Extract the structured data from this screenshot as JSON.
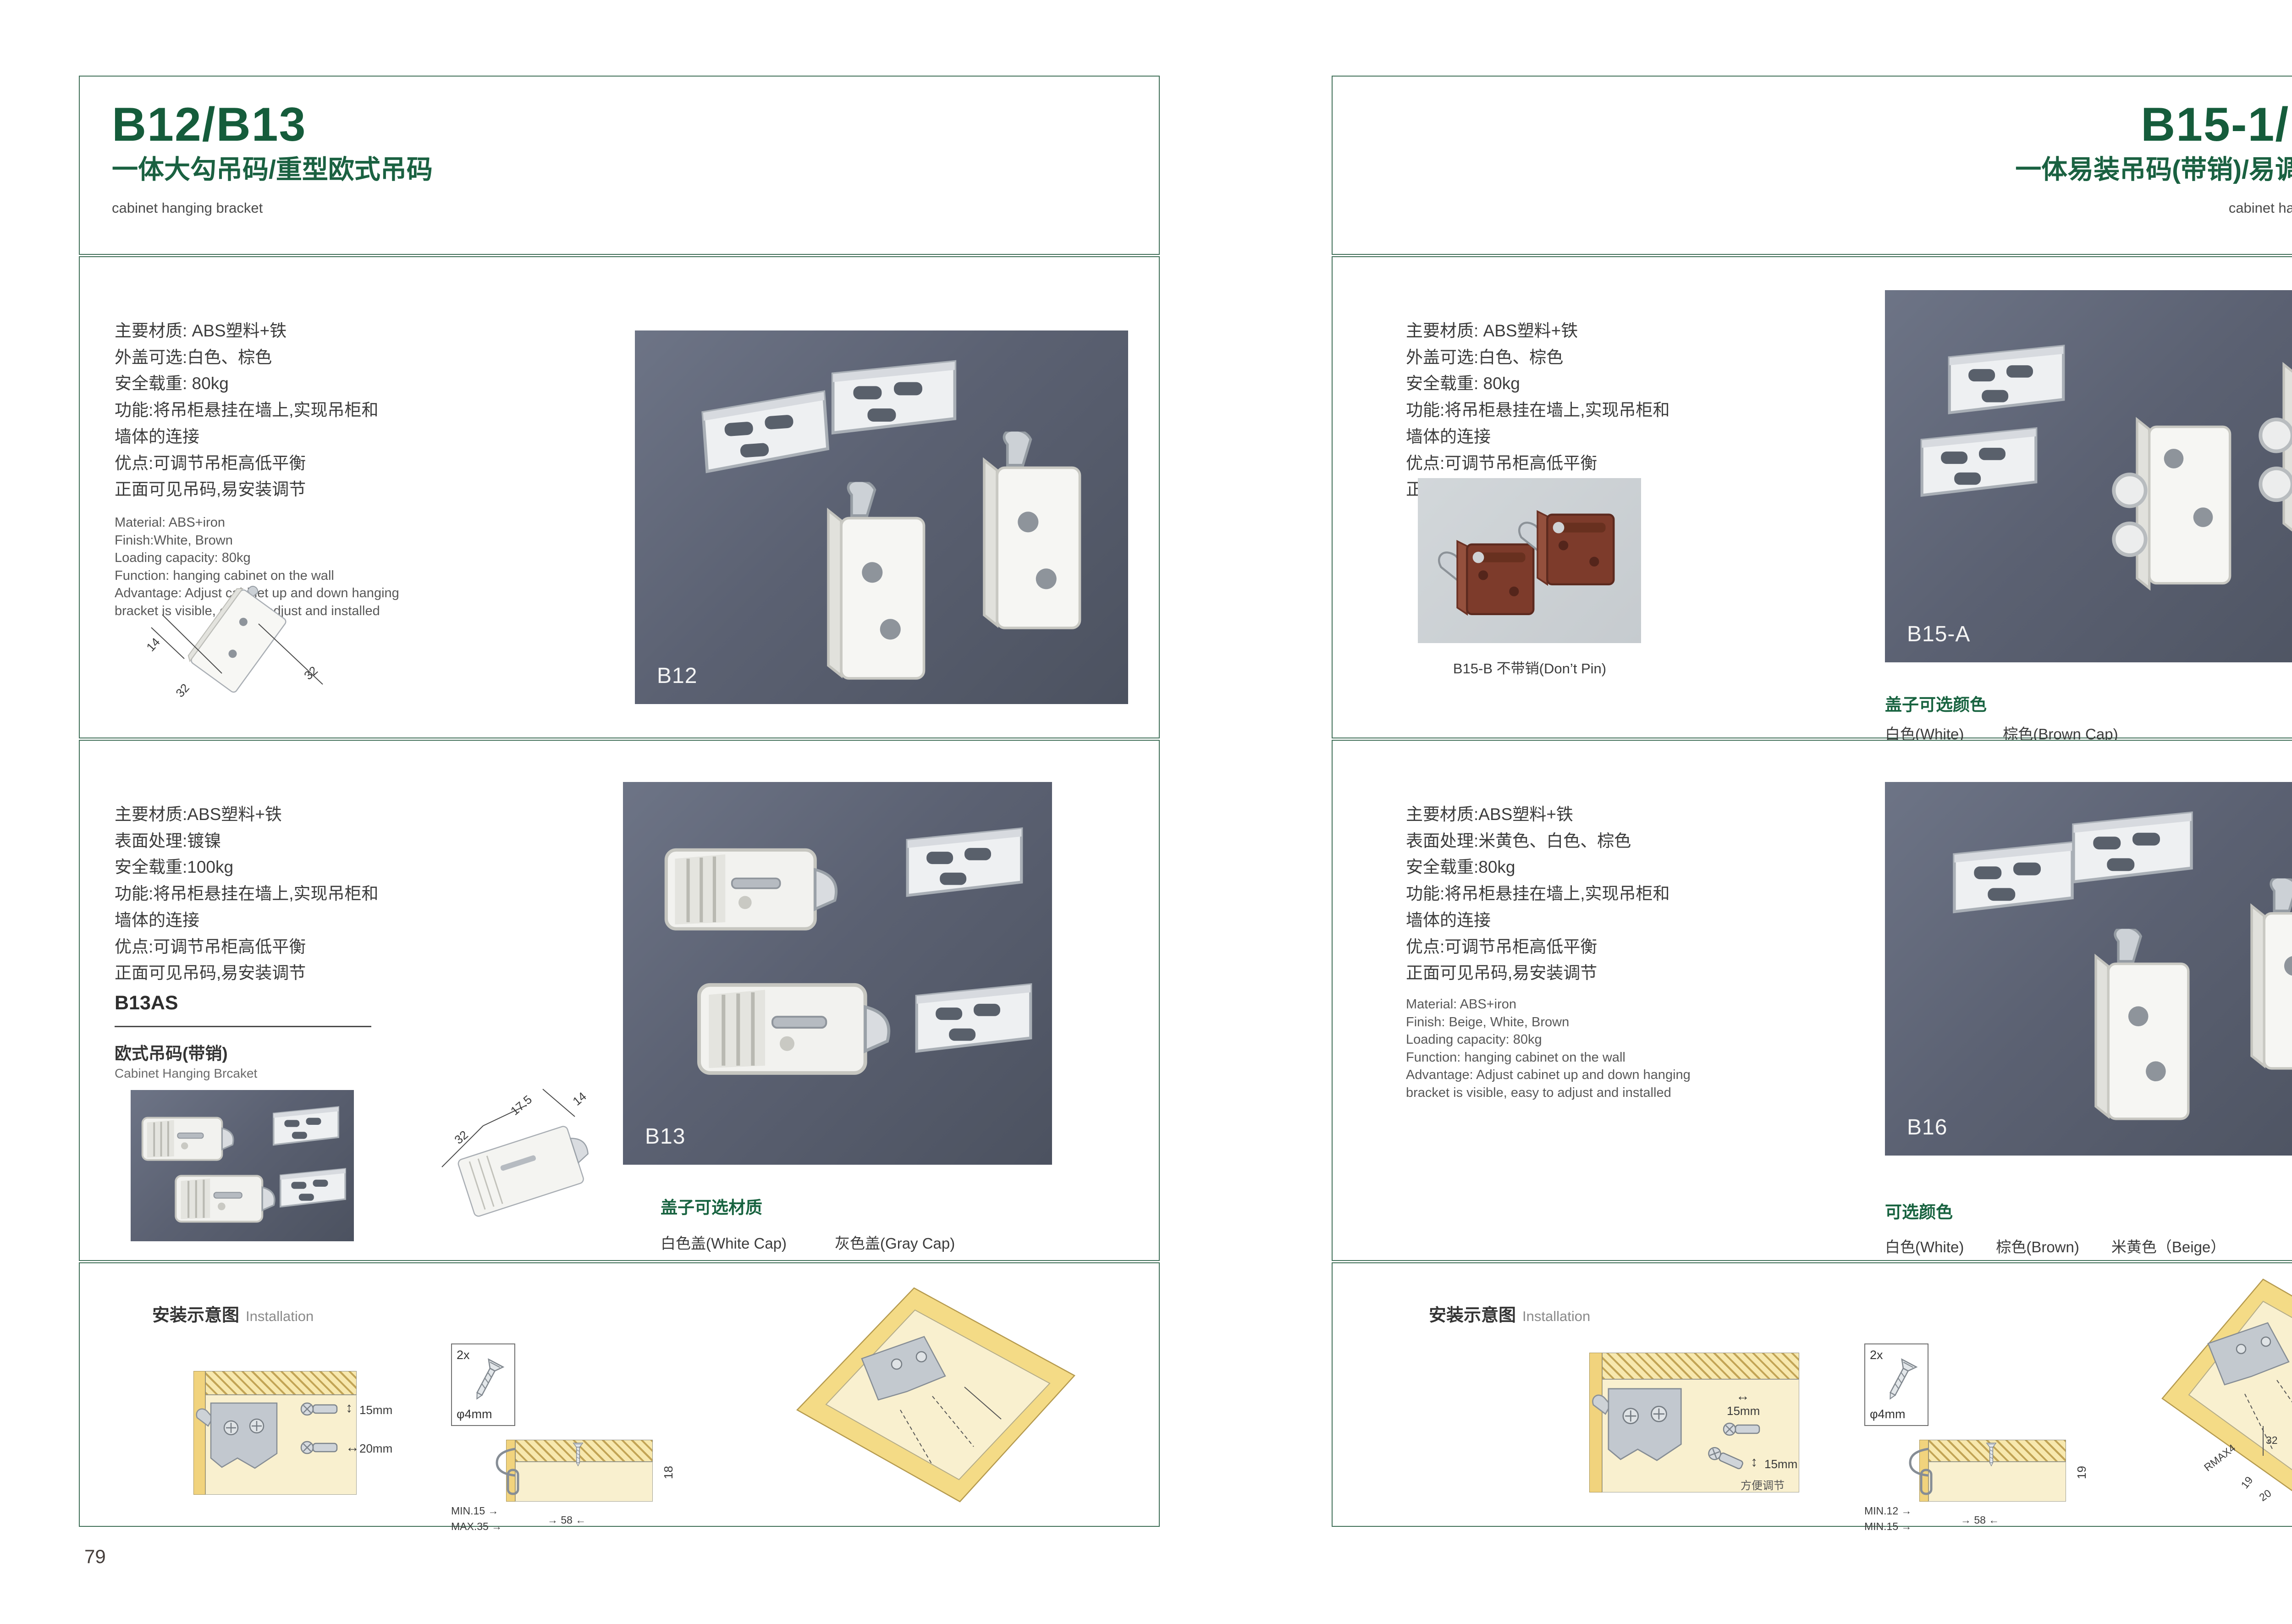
{
  "icons": {
    "dim_arrow_v": "↕",
    "dim_arrow_h": "↔",
    "dim_arrow_r": "→",
    "dim_arrow_l": "←"
  },
  "left_page": {
    "page_number": "79",
    "header": {
      "title": "B12/B13",
      "subtitle": "一体大勾吊码/重型欧式吊码",
      "caption": "cabinet hanging bracket"
    },
    "b12": {
      "specs_cn": [
        "主要材质: ABS塑料+铁",
        "外盖可选:白色、棕色",
        "安全载重: 80kg",
        "功能:将吊柜悬挂在墙上,实现吊柜和",
        "墙体的连接",
        "优点:可调节吊柜高低平衡",
        "正面可见吊码,易安装调节"
      ],
      "specs_en": [
        "Material: ABS+iron",
        "Finish:White, Brown",
        "Loading capacity: 80kg",
        "Function: hanging cabinet on the wall",
        "Advantage: Adjust cabinet up and down hanging",
        "bracket is visible, easy to adjust and installed"
      ],
      "diagram_dims": {
        "d1": "14",
        "d2": "32",
        "d3": "32"
      },
      "photo_label": "B12"
    },
    "b13": {
      "specs_cn": [
        "主要材质:ABS塑料+铁",
        "表面处理:镀镍",
        "安全载重:100kg",
        "功能:将吊柜悬挂在墙上,实现吊柜和",
        "墙体的连接",
        "优点:可调节吊柜高低平衡",
        "正面可见吊码,易安装调节"
      ],
      "model": "B13AS",
      "model_desc_cn": "欧式吊码(带销)",
      "model_desc_en": "Cabinet Hanging Brcaket",
      "diagram_dims": {
        "d1": "32",
        "d2": "17.5",
        "d3": "14"
      },
      "photo_label": "B13",
      "cap_title": "盖子可选材质",
      "cap_options": [
        "白色盖(White Cap)",
        "灰色盖(Gray Cap)"
      ]
    },
    "installation": {
      "title_cn": "安装示意图",
      "title_en": "Installation",
      "d1": {
        "dim_v": "15mm",
        "dim_h": "20mm"
      },
      "d2": {
        "count": "2x",
        "dia": "φ4mm",
        "depth": "18",
        "min": "MIN.15",
        "max": "MAX.35",
        "width": "58"
      }
    }
  },
  "right_page": {
    "page_number": "80",
    "header": {
      "title": "B15-1/B16",
      "subtitle": "一体易装吊码(带销)/易调节吊码",
      "caption": "cabinet hanging bracket"
    },
    "b15": {
      "specs_cn": [
        "主要材质: ABS塑料+铁",
        "外盖可选:白色、棕色",
        "安全载重: 80kg",
        "功能:将吊柜悬挂在墙上,实现吊柜和",
        "墙体的连接",
        "优点:可调节吊柜高低平衡",
        "正面可见吊码,易安装调节"
      ],
      "sub_photo_caption": "B15-B 不带销(Don’t Pin)",
      "photo_label": "B15-A",
      "cap_title": "盖子可选颜色",
      "cap_options": [
        "白色(White)",
        "棕色(Brown Cap)"
      ]
    },
    "b16": {
      "specs_cn": [
        "主要材质:ABS塑料+铁",
        "表面处理:米黄色、白色、棕色",
        "安全载重:80kg",
        "功能:将吊柜悬挂在墙上,实现吊柜和",
        "墙体的连接",
        "优点:可调节吊柜高低平衡",
        "正面可见吊码,易安装调节"
      ],
      "specs_en": [
        "Material: ABS+iron",
        "Finish: Beige, White, Brown",
        "Loading capacity: 80kg",
        "Function: hanging cabinet on the wall",
        "Advantage: Adjust cabinet up and down hanging",
        "bracket is visible, easy to adjust and installed"
      ],
      "photo_label": "B16",
      "cap_title": "可选颜色",
      "cap_options": [
        "白色(White)",
        "棕色(Brown)",
        "米黄色（Beige）"
      ]
    },
    "installation": {
      "title_cn": "安装示意图",
      "title_en": "Installation",
      "d1": {
        "dim_h": "15mm",
        "dim_v": "15mm",
        "note": "方便调节"
      },
      "d2": {
        "count": "2x",
        "dia": "φ4mm",
        "depth": "19",
        "min": "MIN.12",
        "min2": "MIN.15",
        "width": "58"
      },
      "d3": {
        "dims": [
          "30",
          "32",
          "RMAX4",
          "19",
          "20",
          "32"
        ]
      }
    }
  }
}
